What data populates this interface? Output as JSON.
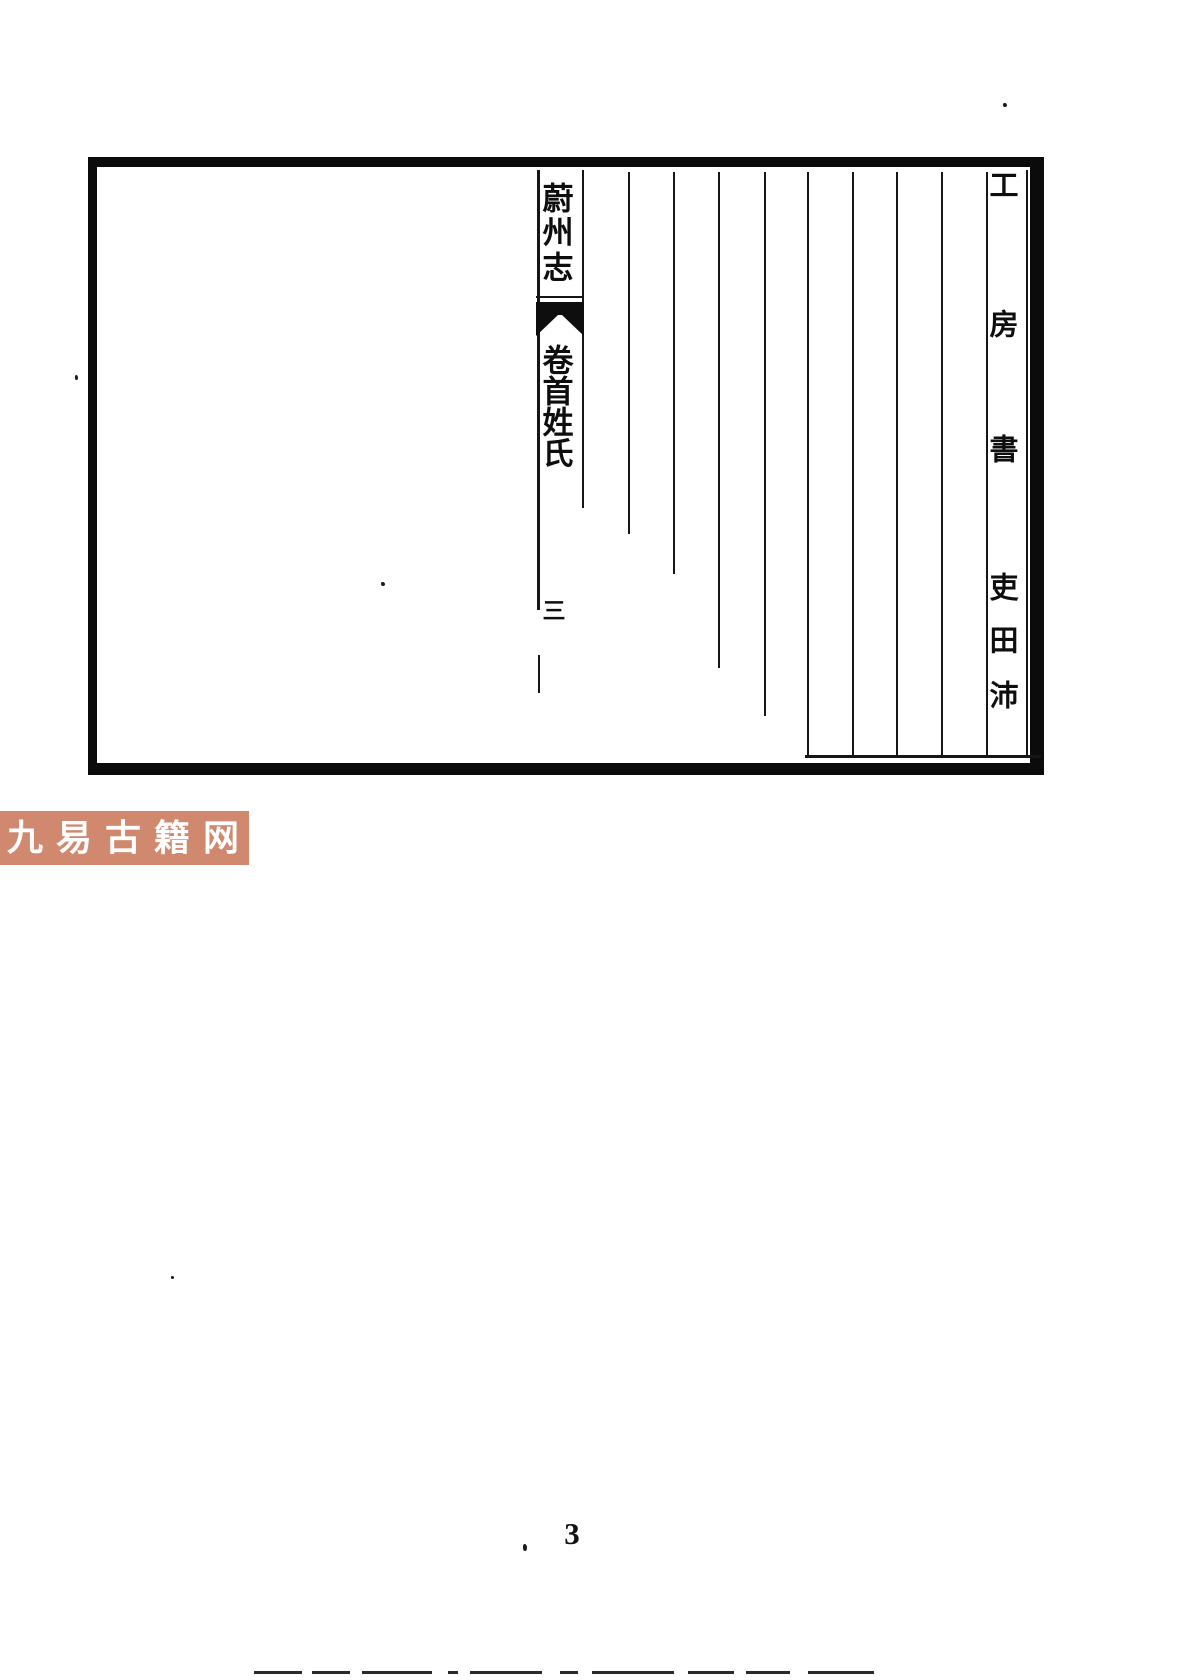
{
  "page": {
    "spine": {
      "title": "蔚州志",
      "section": "卷首姓氏",
      "folio": "三"
    },
    "right_column": "工房書吏田沛",
    "page_number": "3",
    "watermark": {
      "text": "九易古籍网"
    }
  },
  "colors": {
    "ink": "#0e0e0e",
    "rule_line": "#161616",
    "watermark_bg": "#d0896f",
    "watermark_text": "#ffffff",
    "paper": "#ffffff"
  }
}
